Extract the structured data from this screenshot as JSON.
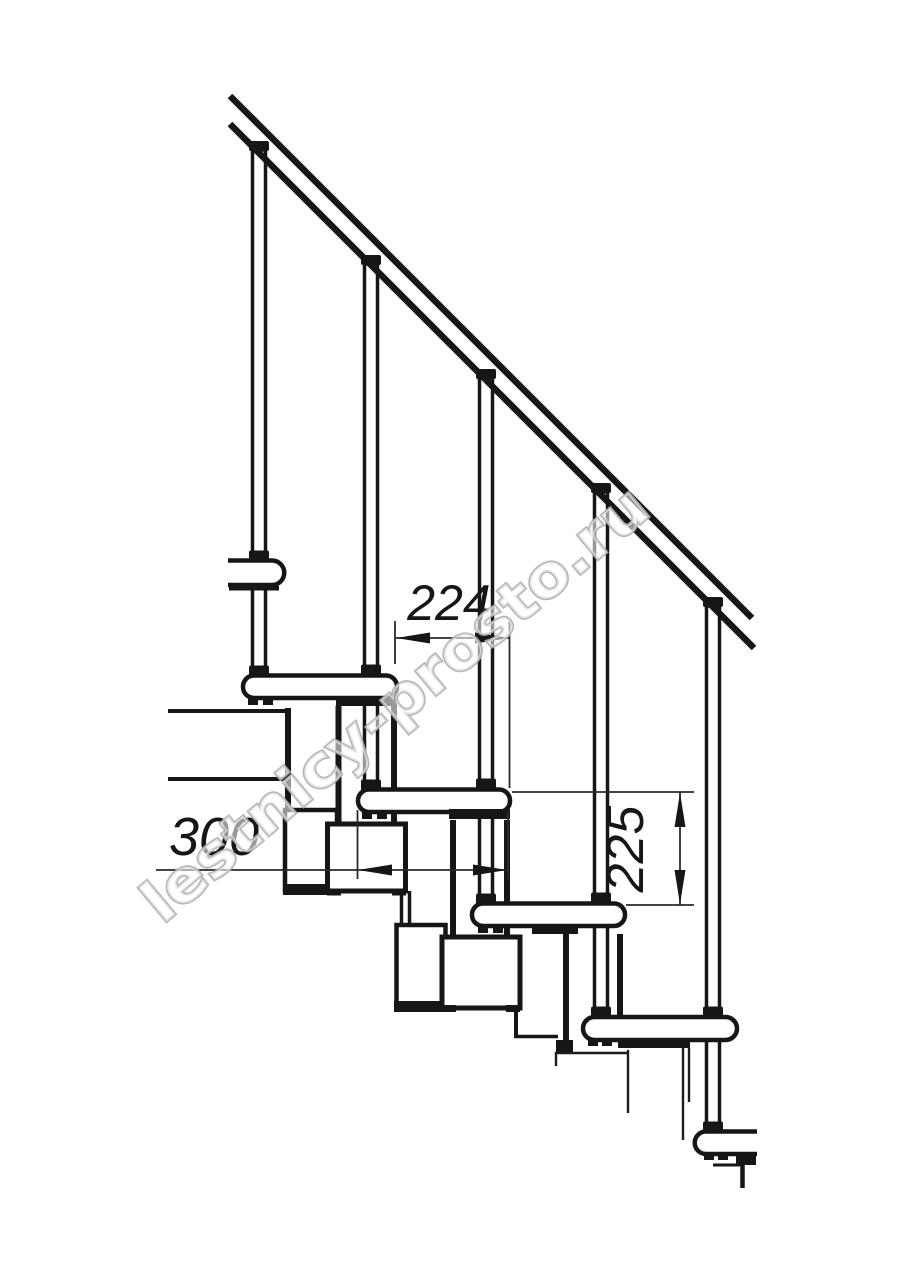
{
  "diagram": {
    "dimensions": {
      "step_run_label": "224",
      "tread_depth_label": "300",
      "riser_height_label": "225"
    },
    "watermark": {
      "text": "lestnicy-prosto.ru",
      "color": "#b0b0b0"
    },
    "colors": {
      "ink": "#161616",
      "background": "#ffffff"
    }
  }
}
